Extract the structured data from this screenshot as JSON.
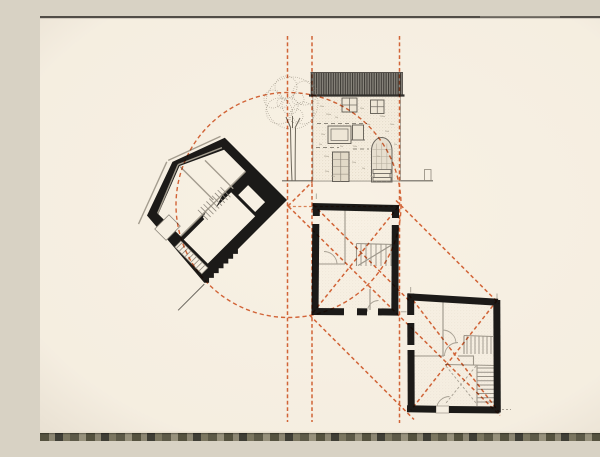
{
  "title": "architectural-study-drawing",
  "canvas": {
    "width": 600,
    "height": 425,
    "paper": "#f8f1e4"
  },
  "palette": {
    "ink": "#1b1a18",
    "gray_dark": "#6b675f",
    "gray": "#8f897c",
    "gray_light": "#a9a295",
    "guide": "#d96a3d",
    "guide_soft": "#e08a60",
    "paper": "#f8f1e4",
    "vignette": "rgba(82,62,36,0.10)"
  },
  "guides": {
    "dash_v": "3.8 2.6",
    "dash_c": "4.2 3",
    "dash_d": "3.8 2.8",
    "verticals": [
      {
        "x": 247.5,
        "y1": 20,
        "y2": 406
      },
      {
        "x": 272.0,
        "y1": 20,
        "y2": 406
      },
      {
        "x": 359.5,
        "y1": 20,
        "y2": 407
      }
    ],
    "horizontal": {
      "y": 190.5,
      "x1": 247.5,
      "x2": 361
    },
    "circle": {
      "cx": 248.5,
      "cy": 189,
      "r": 112.5
    },
    "diagonals": [
      {
        "x1": 248.0,
        "y1": 190.0,
        "x2": 272.5,
        "y2": 165.5
      },
      {
        "x1": 273.0,
        "y1": 188.5,
        "x2": 371.0,
        "y2": 286.5
      },
      {
        "x1": 248.5,
        "y1": 190.5,
        "x2": 460.0,
        "y2": 399.5
      },
      {
        "x1": 356.0,
        "y1": 184.5,
        "x2": 459.0,
        "y2": 287.5
      },
      {
        "x1": 269.5,
        "y1": 299.0,
        "x2": 374.0,
        "y2": 403.5
      },
      {
        "x1": 358.0,
        "y1": 191.0,
        "x2": 271.5,
        "y2": 298.5
      },
      {
        "x1": 369.0,
        "y1": 279.0,
        "x2": 459.0,
        "y2": 396.0
      },
      {
        "x1": 457.0,
        "y1": 284.5,
        "x2": 371.0,
        "y2": 394.0
      }
    ]
  },
  "elevation": {
    "ground": {
      "x1": 242,
      "y1": 164.8,
      "x2": 393,
      "y2": 164.8
    },
    "post": {
      "x": 384.5,
      "y": 153.5,
      "w": 6.5,
      "h": 11
    },
    "roof": {
      "x": 270.5,
      "y": 56.5,
      "w": 92.5,
      "h": 23
    },
    "facade": {
      "x": 272.8,
      "y": 79.5,
      "w": 87.7,
      "h": 85.5
    },
    "windows": [
      {
        "x": 302.0,
        "y": 82.0,
        "w": 15.0,
        "h": 14.0,
        "bars": "cross"
      },
      {
        "x": 330.5,
        "y": 84.0,
        "w": 13.5,
        "h": 13.5,
        "bars": "cross"
      },
      {
        "x": 288.0,
        "y": 110.0,
        "w": 23.0,
        "h": 17.5,
        "bars": "inner"
      },
      {
        "x": 312.5,
        "y": 109.0,
        "w": 11.0,
        "h": 15.0,
        "bars": "sill"
      }
    ],
    "door": {
      "x": 292.5,
      "y": 136,
      "w": 16.5,
      "h": 29.5
    },
    "arch": {
      "x": 331.5,
      "y": 121.5,
      "w": 20.5,
      "h": 44.5
    },
    "steps": [
      [
        333,
        153.5,
        18,
        4
      ],
      [
        334,
        157.5,
        16,
        4
      ],
      [
        333,
        161.5,
        18,
        3.5
      ]
    ],
    "dash_rows": [
      {
        "y": 107.5,
        "x1": 277,
        "x2": 327
      },
      {
        "y": 131.5,
        "x1": 276,
        "x2": 299
      },
      {
        "y": 133.0,
        "x1": 313,
        "x2": 329
      }
    ],
    "marks": [
      [
        280,
        90,
        4
      ],
      [
        286,
        98,
        5
      ],
      [
        295,
        101,
        3
      ],
      [
        320,
        92,
        4
      ],
      [
        340,
        100,
        5
      ],
      [
        350,
        108,
        4
      ],
      [
        281,
        118,
        4
      ],
      [
        313,
        130,
        4
      ],
      [
        284,
        140,
        5
      ],
      [
        312,
        146,
        4
      ],
      [
        322,
        152,
        3
      ],
      [
        285,
        155,
        4
      ],
      [
        300,
        130,
        3
      ],
      [
        345,
        115,
        4
      ],
      [
        327,
        108,
        3
      ],
      [
        337,
        140,
        3
      ],
      [
        279,
        128,
        3
      ],
      [
        354,
        128,
        3
      ],
      [
        291,
        160,
        4
      ],
      [
        330,
        160,
        3
      ]
    ],
    "tree": {
      "canopy": [
        [
          252,
          87,
          26
        ],
        [
          239,
          95,
          13
        ],
        [
          265,
          77,
          12
        ],
        [
          246,
          71,
          11
        ],
        [
          263,
          97,
          11
        ],
        [
          233,
          83,
          9
        ],
        [
          250,
          90,
          8
        ],
        [
          258,
          83,
          6
        ],
        [
          242,
          87,
          5
        ],
        [
          256,
          100,
          7
        ]
      ],
      "trunk": [
        "M250.5,112 C250.8,130 251.2,148 252,164.5",
        "M255.5,112 C255.3,130 255,148 255.2,164.5",
        "M252.5,112 L252.5,100",
        "M250.8,112 L246,101",
        "M255,112 L260,102"
      ]
    }
  },
  "section": {
    "origin": [
      247,
      184
    ],
    "angle": -45,
    "outline": [
      [
        0,
        0
      ],
      [
        0,
        -88
      ],
      [
        -54,
        -108
      ],
      [
        -110,
        -88
      ],
      [
        -117,
        0
      ]
    ],
    "zigzag": {
      "teeth": 7,
      "size": 3.4
    },
    "cutouts": {
      "upper_room": [
        [
          -9,
          -50
        ],
        [
          -9,
          -80
        ],
        [
          -52,
          -100
        ],
        [
          -101,
          -81
        ],
        [
          -101,
          -50
        ]
      ],
      "lower_room": [
        [
          -101,
          -11
        ],
        [
          -101,
          -45
        ],
        [
          -34,
          -45
        ],
        [
          -34,
          -11
        ]
      ],
      "stair_band": [
        [
          -72,
          -40
        ],
        [
          -36,
          -51
        ],
        [
          -36,
          -58
        ],
        [
          -72,
          -47
        ]
      ],
      "door_recess": [
        [
          -31,
          -14
        ],
        [
          -17,
          -14
        ],
        [
          -17,
          -38
        ],
        [
          -31,
          -38
        ]
      ],
      "left_stair": [
        [
          -112.5,
          -8
        ],
        [
          -104,
          -8
        ],
        [
          -104,
          -46
        ],
        [
          -112.5,
          -46
        ]
      ]
    },
    "window_box": {
      "x": -114,
      "y": -73,
      "w": 20,
      "h": 16
    },
    "gray_lines": [
      [
        -101,
        -49.5,
        -9,
        -49.5
      ],
      [
        -9,
        -83,
        -52,
        -102
      ],
      [
        -52,
        -102,
        -101,
        -82
      ],
      [
        -58,
        -112,
        -114,
        -91
      ],
      [
        -114,
        -91,
        -122,
        -88
      ],
      [
        -2,
        -92,
        -56,
        -112
      ],
      [
        -52,
        -52,
        -52,
        -99
      ],
      [
        -30,
        -46,
        -30,
        -86
      ]
    ],
    "treads": [
      {
        "dir": "v",
        "a": -70,
        "b": -38,
        "step": 4,
        "c": -42,
        "d": -56
      },
      {
        "dir": "h",
        "a": -12,
        "b": -44,
        "step": 4,
        "c": -112,
        "d": -104.5
      }
    ],
    "tip_line": [
      -118,
      1,
      -155,
      1
    ]
  },
  "plans": {
    "middle": {
      "wall_w": 7,
      "walls": [
        [
          272.5,
          190.5,
          359,
          192.5
        ],
        [
          276.3,
          187.8,
          276.3,
          200
        ],
        [
          275.8,
          208,
          275,
          299
        ],
        [
          355.5,
          192.5,
          355.5,
          202
        ],
        [
          355.3,
          209,
          354.8,
          299
        ],
        [
          271.5,
          295.5,
          304,
          295.7
        ],
        [
          317,
          295.8,
          327,
          295.9
        ],
        [
          338,
          295.9,
          358.3,
          296.1
        ]
      ],
      "inner_rect": [
        279,
        195,
        73,
        97
      ],
      "interior_lines": [
        [
          305,
          194,
          305,
          248
        ],
        [
          277,
          248,
          305,
          248
        ],
        [
          316.5,
          227.5,
          355,
          228.5
        ],
        [
          316.5,
          227.5,
          316.5,
          250
        ],
        [
          318,
          249.5,
          351.5,
          229
        ],
        [
          330,
          273,
          330,
          294
        ]
      ],
      "stairs": [
        {
          "dir": "v",
          "a": 321,
          "b": 351,
          "step": 5,
          "c": 228,
          "d": 250
        }
      ],
      "arcs": [
        "M 297,248 A 13 13 0 0 0 284,235.5",
        "M 338.5,284.5 A 11 11 0 0 0 327.5,295.5"
      ],
      "crosses": [],
      "ticks": [
        {
          "l": [
            276.3,
            177.5,
            276.3,
            183
          ]
        },
        {
          "l": [
            361,
            295.8,
            366.5,
            295.8
          ]
        }
      ]
    },
    "bottom": {
      "wall_w": 7,
      "walls": [
        [
          367.5,
          280.8,
          458,
          286.3
        ],
        [
          456.8,
          284,
          457.3,
          396.5
        ],
        [
          367,
          392.8,
          396,
          393.3
        ],
        [
          409,
          393.5,
          459.5,
          394
        ],
        [
          370.7,
          277.5,
          370.7,
          299
        ],
        [
          370.8,
          307,
          370.9,
          329
        ],
        [
          371,
          334,
          371.2,
          392
        ]
      ],
      "inner_rect": [
        374,
        286,
        80,
        104
      ],
      "interior_lines": [
        [
          403,
          286,
          403,
          340
        ],
        [
          371,
          340,
          404,
          340
        ],
        [
          418,
          340,
          434,
          340
        ],
        [
          424,
          319.5,
          453,
          320.5
        ],
        [
          424,
          319.5,
          424,
          338
        ],
        [
          405,
          348.5,
          456,
          349.5
        ],
        [
          437,
          349,
          437,
          390
        ],
        [
          433.5,
          340,
          433.5,
          349
        ]
      ],
      "stairs": [
        {
          "dir": "v",
          "a": 427,
          "b": 451,
          "step": 4,
          "c": 320.5,
          "d": 338
        },
        {
          "dir": "h",
          "a": 352,
          "b": 386,
          "step": 4.25,
          "c": 437.5,
          "d": 456
        }
      ],
      "arcs": [
        "M 416,327.5 A 13.5 13.5 0 0 0 402.5,314",
        "M 404.5,340 A 13.5 13.5 0 0 1 418,326.5",
        "M 409.5,380.5 A 13 13 0 0 0 396.5,393.3"
      ],
      "crosses": [
        [
          406,
          350,
          436,
          387
        ],
        [
          436,
          350,
          406,
          387
        ]
      ],
      "threshold": {
        "x": 396,
        "y": 390,
        "w": 13,
        "h": 7
      },
      "ticks": [
        {
          "l": [
            370.7,
            271,
            370.7,
            276.5
          ]
        },
        {
          "l": [
            457,
            277.5,
            457,
            282.5
          ]
        },
        {
          "l": [
            462,
            393.5,
            471,
            393.5
          ],
          "dash": "2 2"
        }
      ]
    }
  },
  "edges": {
    "top": {
      "h": 2.2,
      "color": "#514d47",
      "light": {
        "x": 440,
        "w": 80,
        "color": "#7d786f"
      }
    },
    "bottom": {
      "y": 417,
      "h": 8,
      "shadow": "#e6decd",
      "colors": [
        [
          "#55523f",
          9
        ],
        [
          "#8c8672",
          6
        ],
        [
          "#3f3e35",
          8
        ],
        [
          "#7b7660",
          7
        ],
        [
          "#5d5a48",
          9
        ],
        [
          "#97917c",
          7
        ]
      ]
    }
  }
}
